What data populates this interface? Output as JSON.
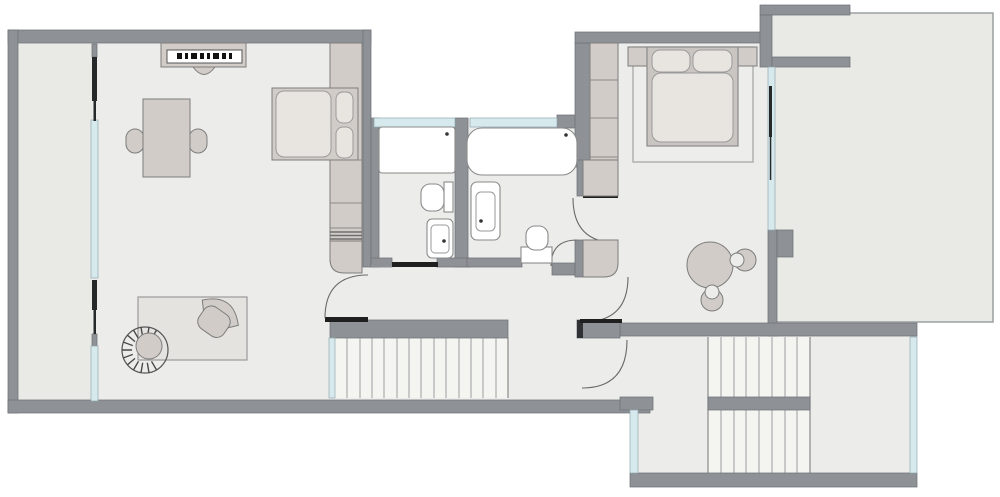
{
  "title": "",
  "colors": {
    "background": "#ffffff",
    "wall": "#8e9296",
    "wall_edge": "#6f7377",
    "floor": "#ececeb",
    "floor_outdoor": "#e9eae5",
    "tread": "#f4f4f1",
    "glass": "#d6e9ed",
    "furniture": "#d1ccc8",
    "bedding": "#e8e5e1",
    "rug": "#e5e3e0",
    "fixture": "#ffffff",
    "door_leaf": "#1f1f1f",
    "swing": "#6a6a6a"
  },
  "inventory": {
    "rooms": [
      "living-room",
      "balcony",
      "bathroom-left",
      "bathroom-right",
      "hallway",
      "bedroom",
      "terrace",
      "stairwell"
    ],
    "stairs": [
      "straight-staircase-mid",
      "u-shaped-staircase-right"
    ],
    "furniture": [
      "sideboard-with-stool",
      "dining-table",
      "dining-chair-left",
      "dining-chair-right",
      "wardrobe-column",
      "double-bed-left",
      "area-rug",
      "lounge-armchair",
      "fan-back-chair",
      "double-bed-right",
      "nightstand-left",
      "nightstand-right",
      "bedroom-closet",
      "round-table",
      "tub-chair-right",
      "tub-chair-bottom"
    ],
    "fixtures": [
      "walk-in-shower",
      "toilet-left-bath",
      "washbasin-left-bath",
      "bathtub",
      "washbasin-right-bath",
      "toilet-right-bath"
    ],
    "openings": [
      "balcony-glass-wall",
      "bath-window-left",
      "bath-window-right",
      "bedroom-glass-wall",
      "stair-glass-left",
      "stairwell-glass-left",
      "stairwell-glass-right",
      "door-living-hall",
      "slider-left-bath",
      "door-right-bath",
      "door-bedroom-upper",
      "door-bedroom-lower",
      "door-hall-stairwell"
    ]
  }
}
